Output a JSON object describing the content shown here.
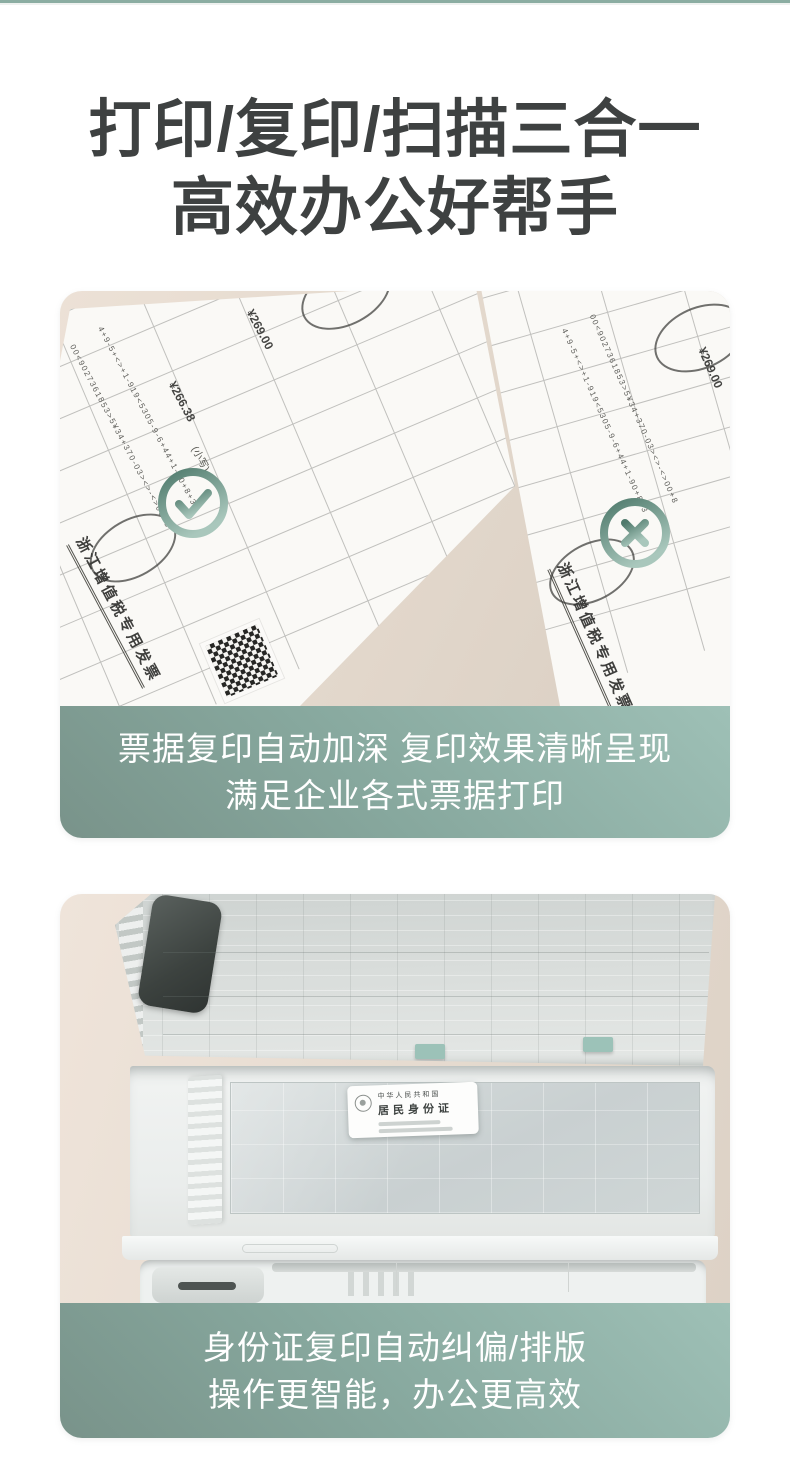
{
  "style": {
    "topbar_color": "#8bada2",
    "banner_gradient_start": "#9ec0b6",
    "banner_gradient_end": "#79938a",
    "heading_color": "#3e4141",
    "caption_text_color": "#ffffff",
    "badge_teal_dark": "#4f7a6c",
    "badge_teal_light": "#a9c7bc",
    "desk_wood_color": "#e3d8cc"
  },
  "header": {
    "line1": "打印/复印/扫描三合一",
    "line2": "高效办公好帮手"
  },
  "section_invoice": {
    "caption_line1": "票据复印自动加深 复印效果清晰呈现",
    "caption_line2": "满足企业各式票据打印",
    "invoice_title": "浙江增值税专用发票",
    "price_total": "¥269.00",
    "price_subtotal": "¥266.38",
    "amount_label": "(小写)",
    "code_strip_1": "00<9027361853>5¥34+370-03><>-<>00+8",
    "code_strip_2": "4+9-5+<>+1-919<5305-9-6+44+1-90+8+3",
    "approved_icon": "check-icon",
    "rejected_icon": "x-icon"
  },
  "section_idcard": {
    "caption_line1": "身份证复印自动纠偏/排版",
    "caption_line2": "操作更智能，办公更高效",
    "idcard": {
      "nation_line": "中华人民共和国",
      "title_line": "居民身份证"
    }
  }
}
